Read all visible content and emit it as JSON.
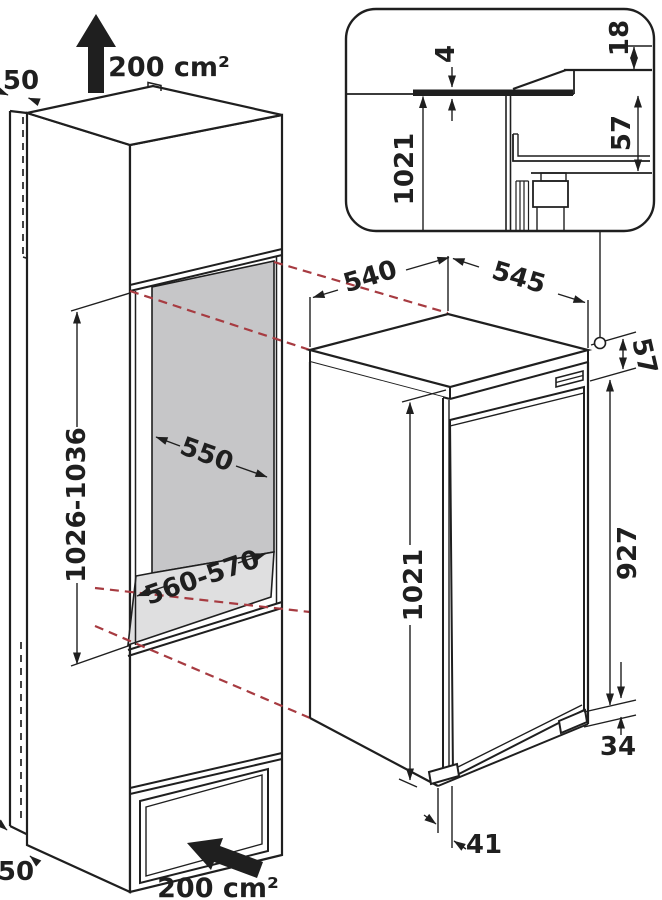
{
  "diagram": {
    "type": "appliance-installation-dimensions",
    "labels": {
      "top_clearance": "50",
      "top_vent_area": "200 cm²",
      "niche_width": "550",
      "niche_height": "1026-1036",
      "niche_depth": "560-570",
      "bottom_clearance": "50",
      "bottom_vent_area": "200 cm²",
      "appliance_depth": "540",
      "appliance_width": "545",
      "top_hinge_offset": "57",
      "appliance_height": "1021",
      "door_height": "927",
      "plinth_height": "34",
      "door_bottom_offset": "41",
      "inset_gap": "4",
      "inset_panel_thickness": "18",
      "inset_appliance_height": "1021",
      "inset_hinge_offset": "57"
    },
    "colors": {
      "line": "#1f1f1f",
      "projection_dashed": "#a73b41",
      "niche_back_wall": "#c6c6c8",
      "niche_floor": "#dfdfe0",
      "background": "#ffffff"
    }
  }
}
